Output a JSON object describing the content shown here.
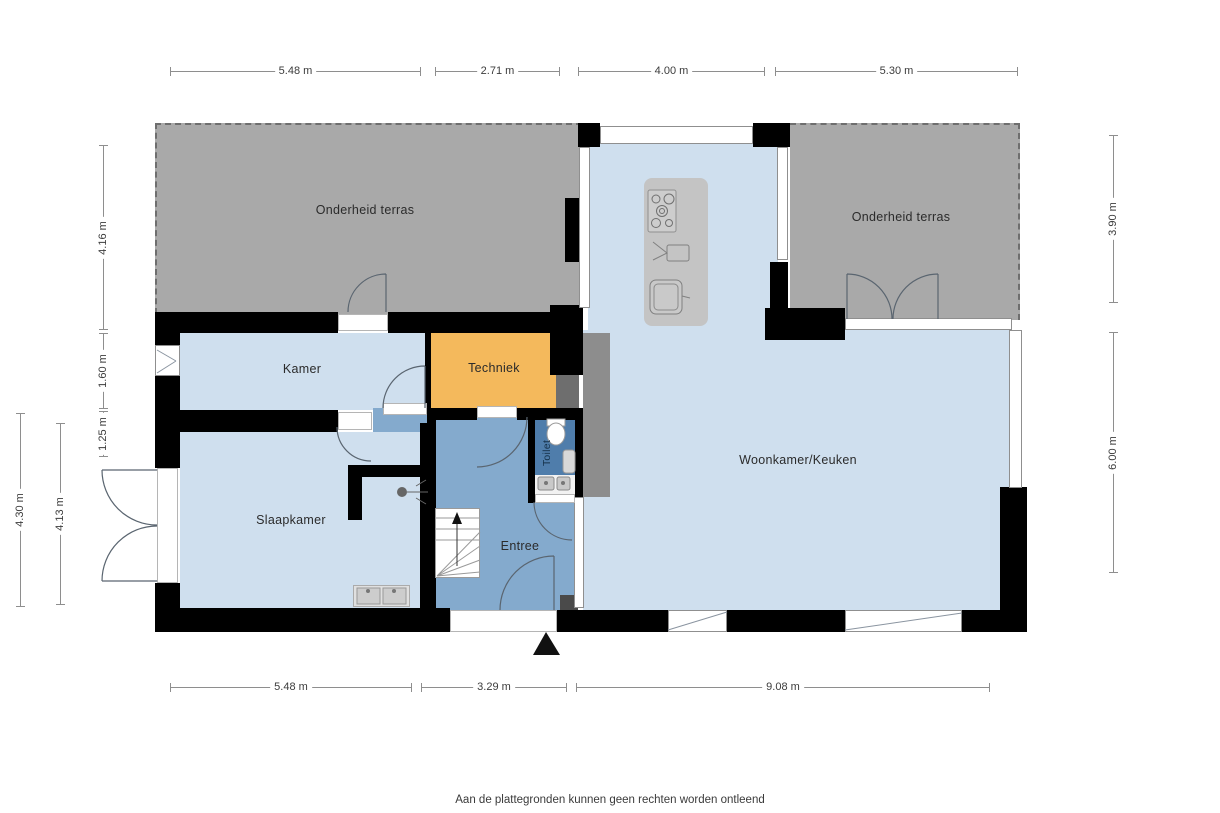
{
  "rooms": {
    "terrace_left": "Onderheid terras",
    "terrace_right": "Onderheid terras",
    "kamer": "Kamer",
    "techniek": "Techniek",
    "toilet": "Toilet",
    "woonkamer": "Woonkamer/Keuken",
    "slaapkamer": "Slaapkamer",
    "entree": "Entree"
  },
  "dims": {
    "top": [
      {
        "label": "5.48 m"
      },
      {
        "label": "2.71 m"
      },
      {
        "label": "4.00 m"
      },
      {
        "label": "5.30 m"
      }
    ],
    "bottom": [
      {
        "label": "5.48 m"
      },
      {
        "label": "3.29 m"
      },
      {
        "label": "9.08 m"
      }
    ],
    "left_inner": [
      {
        "label": "4.16 m"
      },
      {
        "label": "1.60 m"
      },
      {
        "label": "1.25 m"
      }
    ],
    "left_outer": [
      {
        "label": "4.30 m"
      },
      {
        "label": "4.13 m"
      }
    ],
    "right": [
      {
        "label": "3.90 m"
      },
      {
        "label": "6.00 m"
      }
    ]
  },
  "footer": "Aan de plattegronden kunnen geen rechten worden ontleend",
  "colors": {
    "wall": "#000000",
    "room_light_blue": "#cfdfee",
    "entree_blue": "#84aacd",
    "toilet_blue": "#4f7dab",
    "techniek_orange": "#f4b95c",
    "terrace_gray": "#a9a9a9"
  }
}
